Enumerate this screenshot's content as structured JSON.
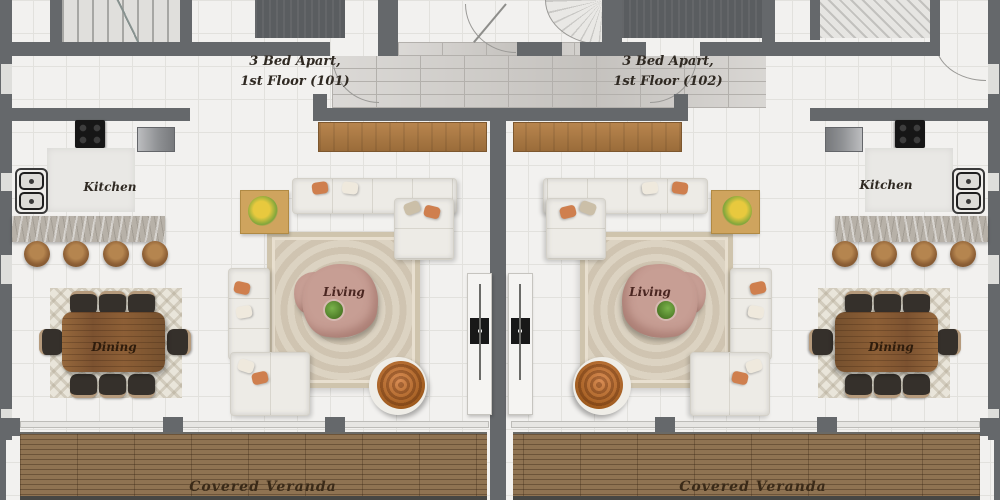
{
  "units": [
    {
      "id": "101",
      "name_line1": "3 Bed Apart,",
      "name_line2": "1st Floor (101)",
      "kitchen_label": "Kitchen",
      "living_label": "Living",
      "dining_label": "Dining",
      "veranda_label": "Covered Veranda"
    },
    {
      "id": "102",
      "name_line1": "3 Bed Apart,",
      "name_line2": "1st Floor (102)",
      "kitchen_label": "Kitchen",
      "living_label": "Living",
      "dining_label": "Dining",
      "veranda_label": "Covered Veranda"
    }
  ],
  "furniture_icons": [
    "stairwell",
    "spiral-stair",
    "entrance-door-swing",
    "cooktop",
    "refrigerator",
    "double-oven",
    "breakfast-bar",
    "bar-stool",
    "tv-console",
    "sectional-sofa",
    "chaise-sofa",
    "coffee-table",
    "house-plant",
    "area-rug",
    "orange-armchair",
    "flower-side-table",
    "dining-table",
    "dining-chair",
    "storage-cabinet",
    "veranda-deck",
    "partition-wall",
    "window-wall"
  ],
  "colors": {
    "wall": "#65686b",
    "floor": "#f2f1ef",
    "tile": "#e2e1dd",
    "brick": "#cfccc8",
    "brickLine": "#b3b0ac",
    "deck": "#8f7352",
    "counter": "#b7b1a8",
    "sofa": "#edebe6",
    "sofaEdge": "#d3d0c8",
    "rug": "#dcd3c2",
    "rugEdge": "#cfc4ad",
    "rose": "#c79e94",
    "chairDark": "#35302b",
    "chairTan": "#b59a7c",
    "ink": "#2f2922"
  }
}
